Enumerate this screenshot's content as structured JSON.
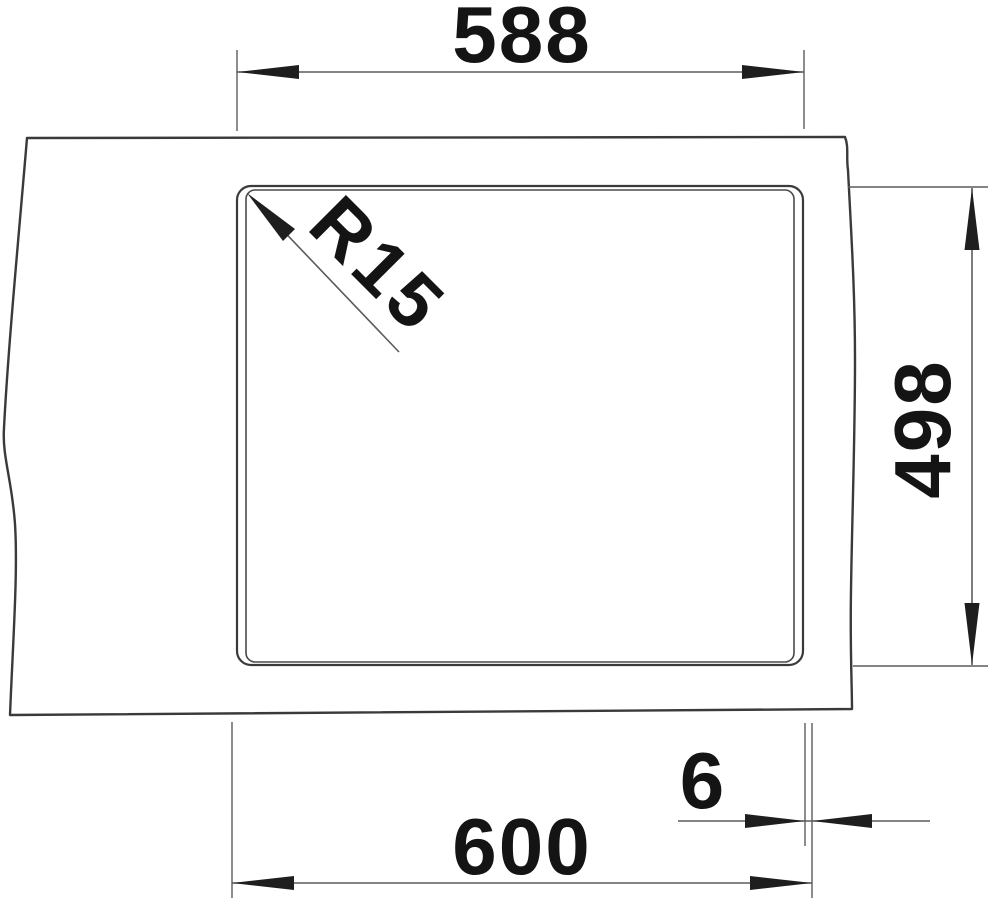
{
  "drawing": {
    "background_color": "#ffffff",
    "outline_color": "#3a3a3a",
    "dim_line_color": "#5c5c5c",
    "arrow_color": "#1e1e1e",
    "text_color": "#141414",
    "labels": {
      "cutout_width": "588",
      "cutout_depth": "498",
      "overall_width": "600",
      "edge_offset": "6",
      "corner_radius": "R15"
    }
  }
}
